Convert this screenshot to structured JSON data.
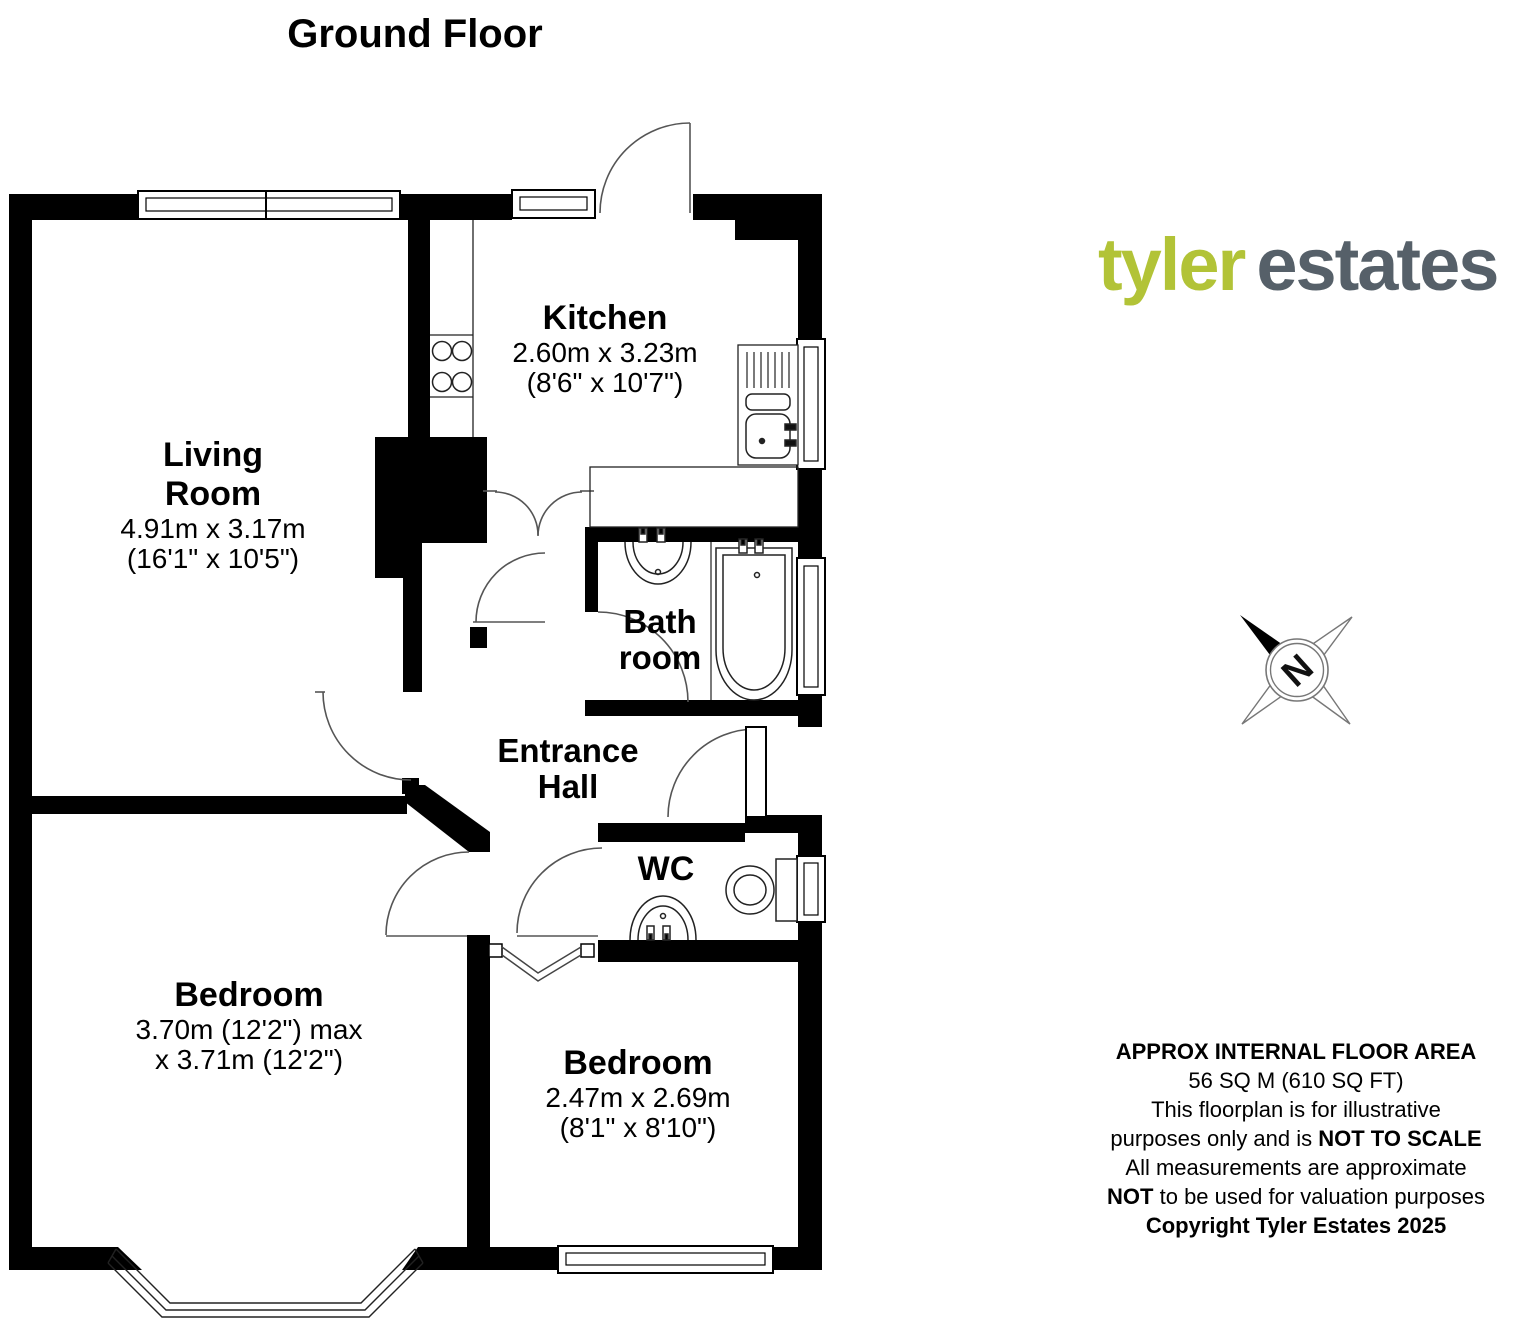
{
  "title": "Ground Floor",
  "logo": {
    "word1": "tyler",
    "word2": "estates",
    "color1": "#b2c337",
    "color2": "#566069"
  },
  "compass": {
    "letter": "N"
  },
  "rooms": {
    "living": {
      "line1": "Living",
      "line2": "Room",
      "dims": "4.91m x 3.17m",
      "dims_imperial": "(16'1\" x 10'5\")"
    },
    "kitchen": {
      "name": "Kitchen",
      "dims": "2.60m x 3.23m",
      "dims_imperial": "(8'6\" x 10'7\")"
    },
    "bathroom": {
      "line1": "Bath",
      "line2": "room"
    },
    "hall": {
      "line1": "Entrance",
      "line2": "Hall"
    },
    "wc": {
      "name": "WC"
    },
    "bedroom1": {
      "name": "Bedroom",
      "dims": "3.70m (12'2\") max",
      "dims2": "x 3.71m (12'2\")"
    },
    "bedroom2": {
      "name": "Bedroom",
      "dims": "2.47m x 2.69m",
      "dims_imperial": "(8'1\" x 8'10\")"
    }
  },
  "disclaimer": {
    "line1": "APPROX INTERNAL FLOOR AREA",
    "line2": "56 SQ M (610 SQ FT)",
    "line3": "This floorplan is for illustrative",
    "line4a": "purposes only and is ",
    "line4b": "NOT TO SCALE",
    "line5": "All measurements are approximate",
    "line6a": "NOT",
    "line6b": " to be used for valuation purposes",
    "line7": "Copyright Tyler Estates 2025"
  },
  "colors": {
    "walls": "#000000",
    "door_arcs": "#555555",
    "fixtures": "#222222"
  }
}
